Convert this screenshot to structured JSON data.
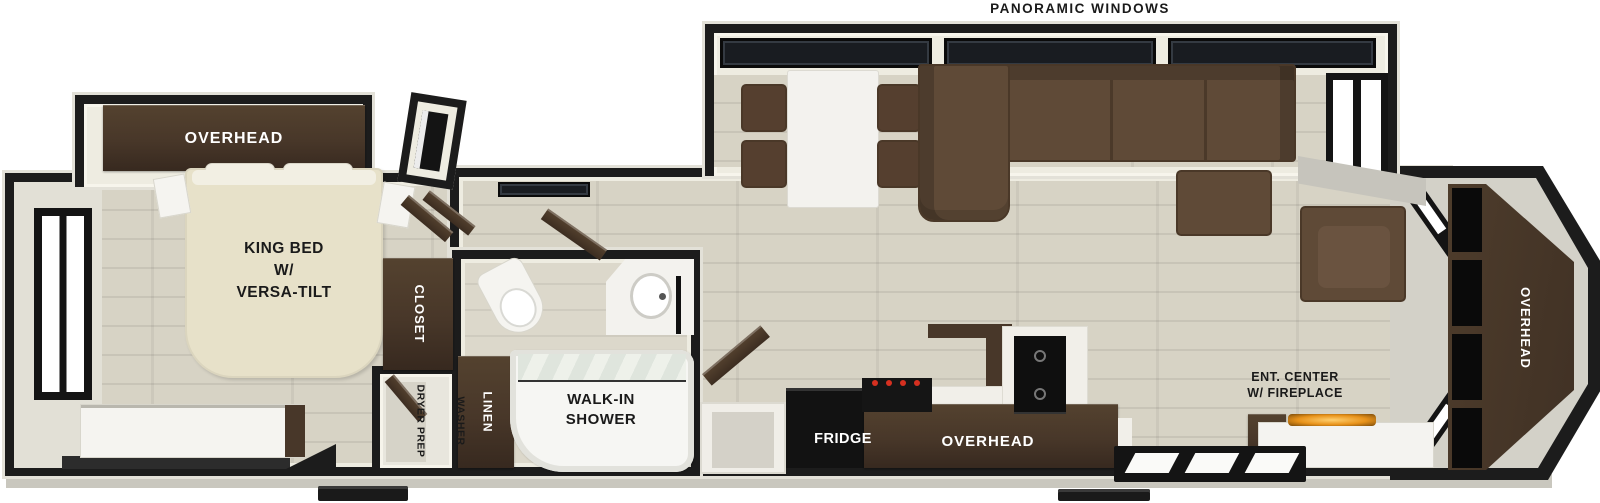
{
  "exterior": {
    "top_label": "PANORAMIC WINDOWS"
  },
  "bedroom": {
    "overhead_label": "OVERHEAD",
    "bed_label": "KING BED\nW/\nVERSA-TILT",
    "closet_label": "CLOSET",
    "washer_label_line1": "WASHER",
    "washer_label_line2": "DRYER PREP"
  },
  "bathroom": {
    "linen_label": "LINEN",
    "shower_label": "WALK-IN\nSHOWER"
  },
  "kitchen": {
    "fridge_label": "FRIDGE",
    "overhead_label": "OVERHEAD"
  },
  "living": {
    "ent_center_label": "ENT. CENTER\nW/ FIREPLACE",
    "rear_overhead_label": "OVERHEAD"
  },
  "colors": {
    "wall": "#1c1c1c",
    "floor": "#d7d3c5",
    "floor_light": "#dcd8cb",
    "cream": "#eeece1",
    "trim": "#c9c7be",
    "cabinet_dark": "#483729",
    "cabinet_darker": "#37291f",
    "appliance_black": "#121212",
    "sofa_brown": "#5f4a37",
    "sofa_dark": "#4a3828",
    "bed_beige": "#e7e1c9",
    "white_fixture": "#f5f4f0",
    "window_glass": "#191c21",
    "fire_glow": "#e8921a",
    "burner_red": "#d63020"
  }
}
